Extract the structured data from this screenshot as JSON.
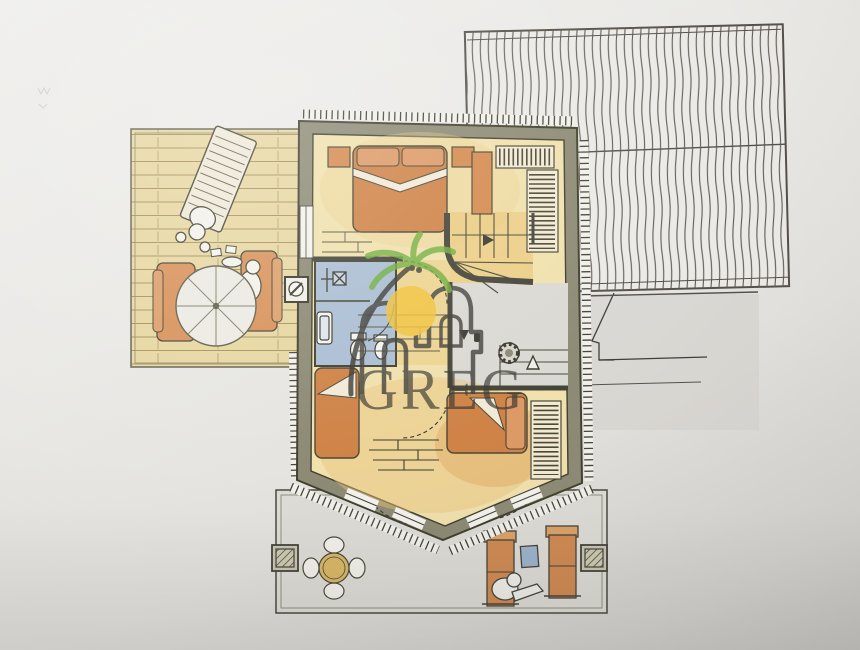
{
  "watermark": {
    "text": "GREG",
    "logo": "palm-tree-over-houses-with-sun"
  },
  "palette": {
    "paper": "#e9e8e5",
    "wall_fill": "#8d8b75",
    "wall_outline": "#42412f",
    "floor_yellow": "#f0e1ad",
    "tile_gold": "#e9c878",
    "furniture_orange": "#d0854c",
    "bathroom_blue": "#abbed3",
    "deck_wood": "#e7d7a2",
    "terrace_gray": "#dedcd6",
    "roof_line": "#5f594f",
    "palm_green": "#6fae3c",
    "sun_yellow": "#f1c23a",
    "watermark_gray": "#3c3b35"
  },
  "plan": {
    "areas": [
      {
        "name": "roof",
        "style": "vertical-hatched shingles with ridge line"
      },
      {
        "name": "side-deck",
        "style": "wood planks"
      },
      {
        "name": "master-bedroom"
      },
      {
        "name": "bathroom"
      },
      {
        "name": "stair-hall"
      },
      {
        "name": "second-bedroom"
      },
      {
        "name": "front-terrace"
      },
      {
        "name": "rear-landing",
        "style": "steps outline"
      }
    ],
    "furniture": {
      "side_deck": [
        "sun-lounger-with-person",
        "parasol",
        "lounge-chair",
        "lounge-chair-with-person",
        "plates"
      ],
      "master_bedroom": [
        "double-bed",
        "nightstand",
        "nightstand",
        "dresser",
        "hanging-wardrobe",
        "hanging-wardrobe"
      ],
      "bathroom": [
        "shower",
        "washbasin",
        "toilet",
        "bidet"
      ],
      "stair_hall": [
        "winder-staircase",
        "direction-arrows",
        "round-column",
        "chimney"
      ],
      "second_bedroom": [
        "single-bed",
        "single-bed",
        "brick-chest",
        "hanging-wardrobe"
      ],
      "front_terrace": [
        "round-dining-table-with-four-chairs",
        "deck-chair-with-person",
        "deck-chair",
        "blue-side-table",
        "planter",
        "planter"
      ]
    }
  }
}
